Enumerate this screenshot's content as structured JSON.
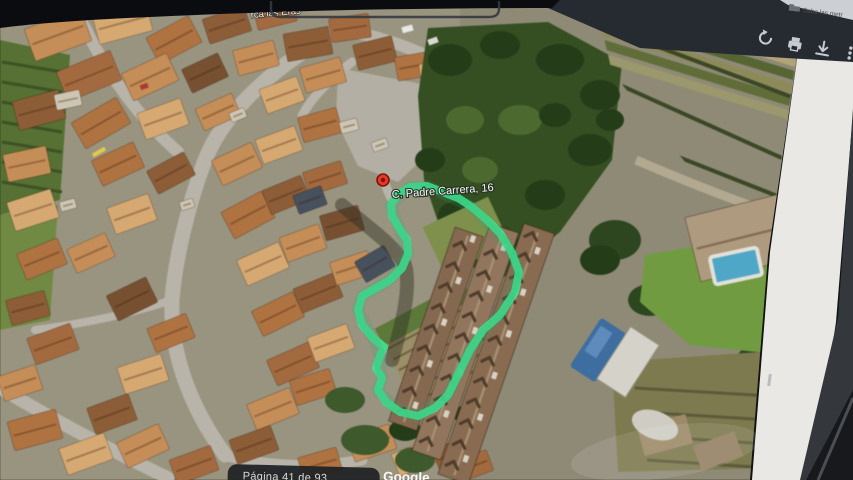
{
  "browser": {
    "bookmarks_label": "Saba las metr",
    "toolbar_icons": [
      "rotate",
      "print",
      "download",
      "more"
    ]
  },
  "viewer": {
    "page_status": "Página 41 de 93"
  },
  "map": {
    "street_label": "rca las Eras",
    "pin_label": "C. Padre Carrera, 16",
    "watermark": "Google",
    "outline_color": "#3fe08f"
  },
  "colors": {
    "toolbar_bg": "#262a31",
    "bezel": "#0a0c10",
    "page_margin": "#e9e8e4",
    "status_pill_bg": "#1e2125",
    "pin_red": "#e4392b",
    "outline_green": "#3fe08f"
  }
}
